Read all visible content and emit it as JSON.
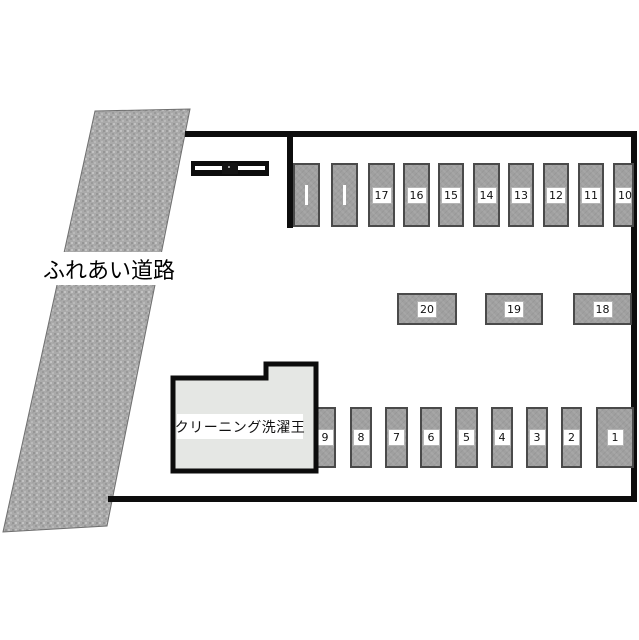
{
  "map": {
    "title": "parking-lot-layout",
    "road": {
      "label": "ふれあい道路"
    },
    "building": {
      "label": "クリーニング洗濯王"
    },
    "gate": {
      "icon": "gate-barrier-icon"
    },
    "rows": {
      "top": [
        "",
        "",
        "17",
        "16",
        "15",
        "14",
        "13",
        "12",
        "11",
        "10"
      ],
      "middle": [
        "20",
        "19",
        "18"
      ],
      "bottom": [
        "9",
        "8",
        "7",
        "6",
        "5",
        "4",
        "3",
        "2",
        "1"
      ]
    },
    "colors": {
      "boundary": "#0d0d0d",
      "stall_fill": "#a0a0a0",
      "stall_border": "#4a4a4a",
      "building_fill": "#e5e7e4",
      "road_fill": "#aaaaaa",
      "label_bg": "#ffffff",
      "label_text": "#111111"
    }
  }
}
